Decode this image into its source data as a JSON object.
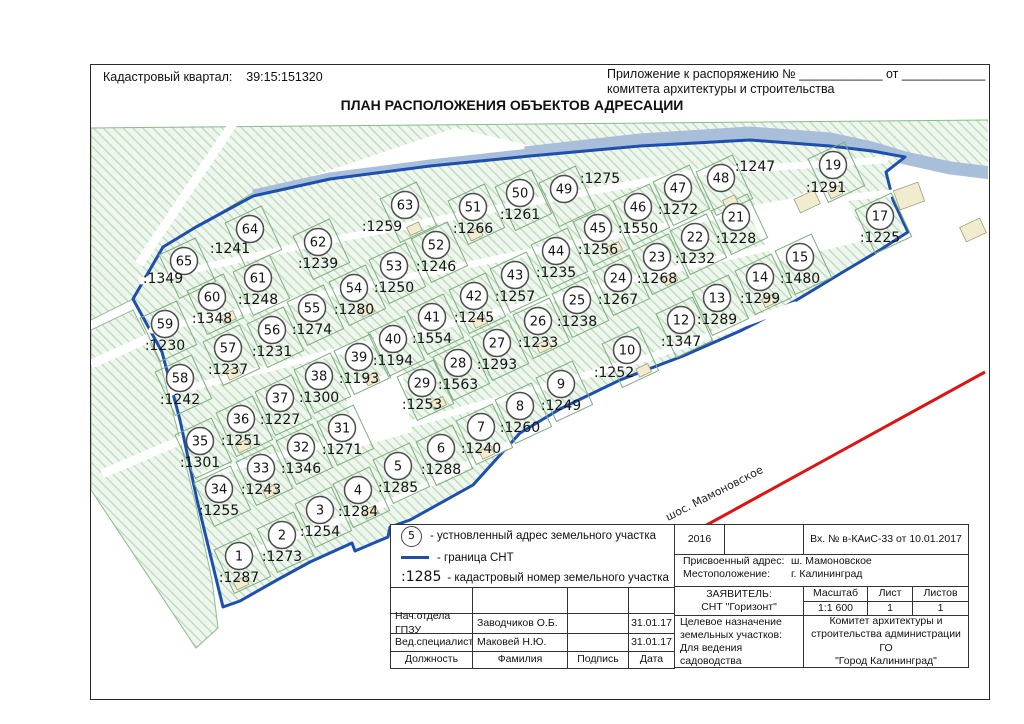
{
  "header": {
    "cadastral_label": "Кадастровый квартал:",
    "cadastral_value": "39:15:151320",
    "annex_line1": "Приложение к распоряжению № ____________ от ____________",
    "annex_line2": "комитета архитектуры и строительства",
    "title": "ПЛАН РАСПОЛОЖЕНИЯ ОБЪЕКТОВ АДРЕСАЦИИ"
  },
  "map": {
    "road_label": "шос. Мамоновское",
    "colors": {
      "boundary": "#1d4fb0",
      "river": "#a9bed9",
      "plot_outline": "#7fae7f",
      "red_line": "#e01313",
      "building": "#f1ecce"
    },
    "plots": [
      {
        "n": "1",
        "k": ":1287",
        "x": 239,
        "y": 556
      },
      {
        "n": "2",
        "k": ":1273",
        "x": 282,
        "y": 535
      },
      {
        "n": "3",
        "k": ":1254",
        "x": 320,
        "y": 510
      },
      {
        "n": "4",
        "k": ":1284",
        "x": 358,
        "y": 490
      },
      {
        "n": "5",
        "k": ":1285",
        "x": 398,
        "y": 466
      },
      {
        "n": "6",
        "k": ":1288",
        "x": 441,
        "y": 448
      },
      {
        "n": "7",
        "k": ":1240",
        "x": 481,
        "y": 427
      },
      {
        "n": "8",
        "k": ":1260",
        "x": 520,
        "y": 406
      },
      {
        "n": "9",
        "k": ":1249",
        "x": 561,
        "y": 384
      },
      {
        "n": "10",
        "k": ":1252",
        "x": 627,
        "y": 350,
        "lx": 614,
        "ly": 373
      },
      {
        "n": "12",
        "k": ":1347",
        "x": 681,
        "y": 320
      },
      {
        "n": "13",
        "k": ":1289",
        "x": 717,
        "y": 298
      },
      {
        "n": "14",
        "k": ":1299",
        "x": 760,
        "y": 277
      },
      {
        "n": "15",
        "k": ":1480",
        "x": 800,
        "y": 257
      },
      {
        "n": "17",
        "k": ":1225",
        "x": 880,
        "y": 216
      },
      {
        "n": "19",
        "k": ":1291",
        "x": 833,
        "y": 165,
        "lx": 826,
        "ly": 188
      },
      {
        "n": "21",
        "k": ":1228",
        "x": 736,
        "y": 217
      },
      {
        "n": "22",
        "k": ":1232",
        "x": 695,
        "y": 237
      },
      {
        "n": "23",
        "k": ":1268",
        "x": 657,
        "y": 257
      },
      {
        "n": "24",
        "k": ":1267",
        "x": 618,
        "y": 278
      },
      {
        "n": "25",
        "k": ":1238",
        "x": 577,
        "y": 300
      },
      {
        "n": "26",
        "k": ":1233",
        "x": 538,
        "y": 321
      },
      {
        "n": "27",
        "k": ":1293",
        "x": 497,
        "y": 343
      },
      {
        "n": "28",
        "k": ":1563",
        "x": 458,
        "y": 363
      },
      {
        "n": "29",
        "k": ":1253",
        "x": 422,
        "y": 383
      },
      {
        "n": "31",
        "k": ":1271",
        "x": 342,
        "y": 428
      },
      {
        "n": "32",
        "k": ":1346",
        "x": 301,
        "y": 447
      },
      {
        "n": "33",
        "k": ":1243",
        "x": 261,
        "y": 468
      },
      {
        "n": "34",
        "k": ":1255",
        "x": 219,
        "y": 489
      },
      {
        "n": "35",
        "k": ":1301",
        "x": 200,
        "y": 441
      },
      {
        "n": "36",
        "k": ":1251",
        "x": 241,
        "y": 419
      },
      {
        "n": "37",
        "k": ":1227",
        "x": 280,
        "y": 398
      },
      {
        "n": "38",
        "k": ":1300",
        "x": 319,
        "y": 376
      },
      {
        "n": "39",
        "k": ":1193",
        "x": 359,
        "y": 357
      },
      {
        "n": "40",
        "k": ":1194",
        "x": 393,
        "y": 339
      },
      {
        "n": "41",
        "k": ":1554",
        "x": 432,
        "y": 317
      },
      {
        "n": "42",
        "k": ":1245",
        "x": 474,
        "y": 296
      },
      {
        "n": "43",
        "k": ":1257",
        "x": 515,
        "y": 275
      },
      {
        "n": "44",
        "k": ":1235",
        "x": 556,
        "y": 251
      },
      {
        "n": "45",
        "k": ":1256",
        "x": 598,
        "y": 228
      },
      {
        "n": "46",
        "k": ":1550",
        "x": 638,
        "y": 207
      },
      {
        "n": "47",
        "k": ":1272",
        "x": 678,
        "y": 188
      },
      {
        "n": "48",
        "k": ":1247",
        "x": 721,
        "y": 178,
        "lx": 755,
        "ly": 167
      },
      {
        "n": "49",
        "k": ":1275",
        "x": 564,
        "y": 189,
        "lx": 600,
        "ly": 179
      },
      {
        "n": "50",
        "k": ":1261",
        "x": 520,
        "y": 193
      },
      {
        "n": "51",
        "k": ":1266",
        "x": 473,
        "y": 207
      },
      {
        "n": "52",
        "k": ":1246",
        "x": 436,
        "y": 245
      },
      {
        "n": "53",
        "k": ":1250",
        "x": 394,
        "y": 266
      },
      {
        "n": "54",
        "k": ":1280",
        "x": 354,
        "y": 288
      },
      {
        "n": "55",
        "k": ":1274",
        "x": 312,
        "y": 308
      },
      {
        "n": "56",
        "k": ":1231",
        "x": 272,
        "y": 330
      },
      {
        "n": "57",
        "k": ":1237",
        "x": 228,
        "y": 348
      },
      {
        "n": "58",
        "k": ":1242",
        "x": 180,
        "y": 378
      },
      {
        "n": "59",
        "k": ":1230",
        "x": 165,
        "y": 324
      },
      {
        "n": "60",
        "k": ":1348",
        "x": 212,
        "y": 297
      },
      {
        "n": "61",
        "k": ":1248",
        "x": 258,
        "y": 278
      },
      {
        "n": "62",
        "k": ":1239",
        "x": 318,
        "y": 242
      },
      {
        "n": "63",
        "k": ":1259",
        "x": 405,
        "y": 205,
        "lx": 382,
        "ly": 227
      },
      {
        "n": "64",
        "k": ":1241",
        "x": 250,
        "y": 229,
        "lx": 230,
        "ly": 249
      },
      {
        "n": "65",
        "k": ":1349",
        "x": 184,
        "y": 261,
        "lx": 163,
        "ly": 279
      }
    ]
  },
  "legend": {
    "item1_symbol": "5",
    "item1_text": "- устновленный адрес земельного участка",
    "item2_text": "- граница СНТ",
    "item3_symbol": ":1285",
    "item3_text": "- кадастровый номер земельного участка"
  },
  "stamp": {
    "left": {
      "rows": [
        {
          "col1": "Нач.отдела ГПЗУ",
          "col2": "Заводчиков О.Б.",
          "col3": "",
          "col4": "31.01.17"
        },
        {
          "col1": "Вед.специалист",
          "col2": "Маковей Н.Ю.",
          "col3": "",
          "col4": "31.01.17"
        },
        {
          "col1": "Должность",
          "col2": "Фамилия",
          "col3": "Подпись",
          "col4": "Дата"
        }
      ]
    },
    "right": {
      "year": "2016",
      "reg": "Вх. № в-КАиС-33 от 10.01.2017",
      "addr_label": "Присвоенный адрес:",
      "addr_value": "ш. Мамоновское",
      "loc_label": "Местоположение:",
      "loc_value": "г. Калининград",
      "applicant_label": "ЗАЯВИТЕЛЬ:",
      "applicant_value": "СНТ \"Горизонт\"",
      "scale_label": "Масштаб",
      "scale_value": "1:1 600",
      "sheet_label": "Лист",
      "sheet_value": "1",
      "sheets_label": "Листов",
      "sheets_value": "1",
      "purpose_line1": "Целевое назначение",
      "purpose_line2": "земельных участков:",
      "purpose_line3": "Для ведения садоводства",
      "committee_line1": "Комитет архитектуры и",
      "committee_line2": "строительства администрации ГО",
      "committee_line3": "\"Город Калининград\""
    }
  }
}
